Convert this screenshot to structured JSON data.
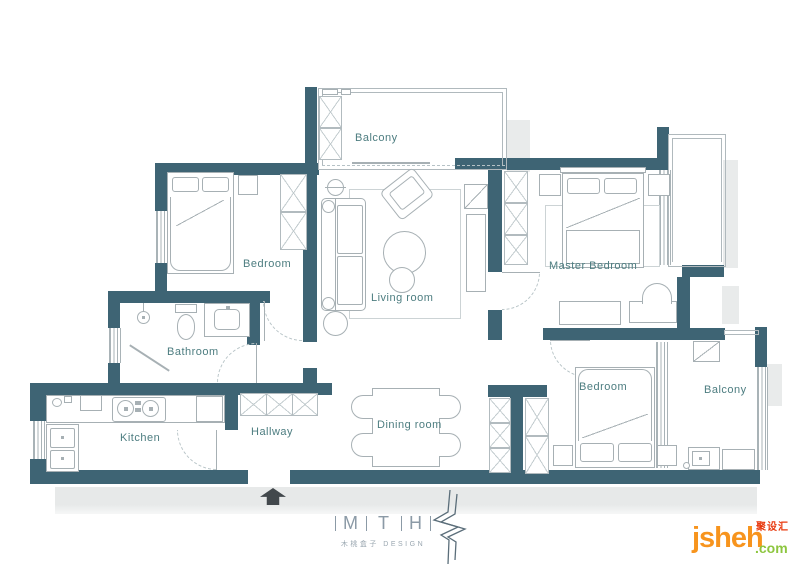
{
  "plan": {
    "rooms": [
      {
        "id": "balcony-top",
        "label": "Balcony"
      },
      {
        "id": "bedroom-left",
        "label": "Bedroom"
      },
      {
        "id": "living-room",
        "label": "Living room"
      },
      {
        "id": "master-bedroom",
        "label": "Master Bedroom"
      },
      {
        "id": "bathroom",
        "label": "Bathroom"
      },
      {
        "id": "kitchen",
        "label": "Kitchen"
      },
      {
        "id": "hallway",
        "label": "Hallway"
      },
      {
        "id": "dining-room",
        "label": "Dining room"
      },
      {
        "id": "bedroom-right",
        "label": "Bedroom"
      },
      {
        "id": "balcony-right",
        "label": "Balcony"
      }
    ],
    "colors": {
      "wall": "#3e6474",
      "room_label": "#4d7d80",
      "furniture_line": "#a7b0b4",
      "shadow": "#e9ebeb"
    }
  },
  "branding": {
    "logo_letters": [
      "M",
      "T",
      "H"
    ],
    "logo_subtitle": "木桃盒子 DESIGN",
    "logo_color": "#8b9aa6"
  },
  "watermark": {
    "brand": "jsheh",
    "tld": ".com",
    "cn_tag": "聚设汇",
    "brand_color": "#f7941d",
    "tld_color": "#8dc63f",
    "cn_color": "#e8380d"
  }
}
